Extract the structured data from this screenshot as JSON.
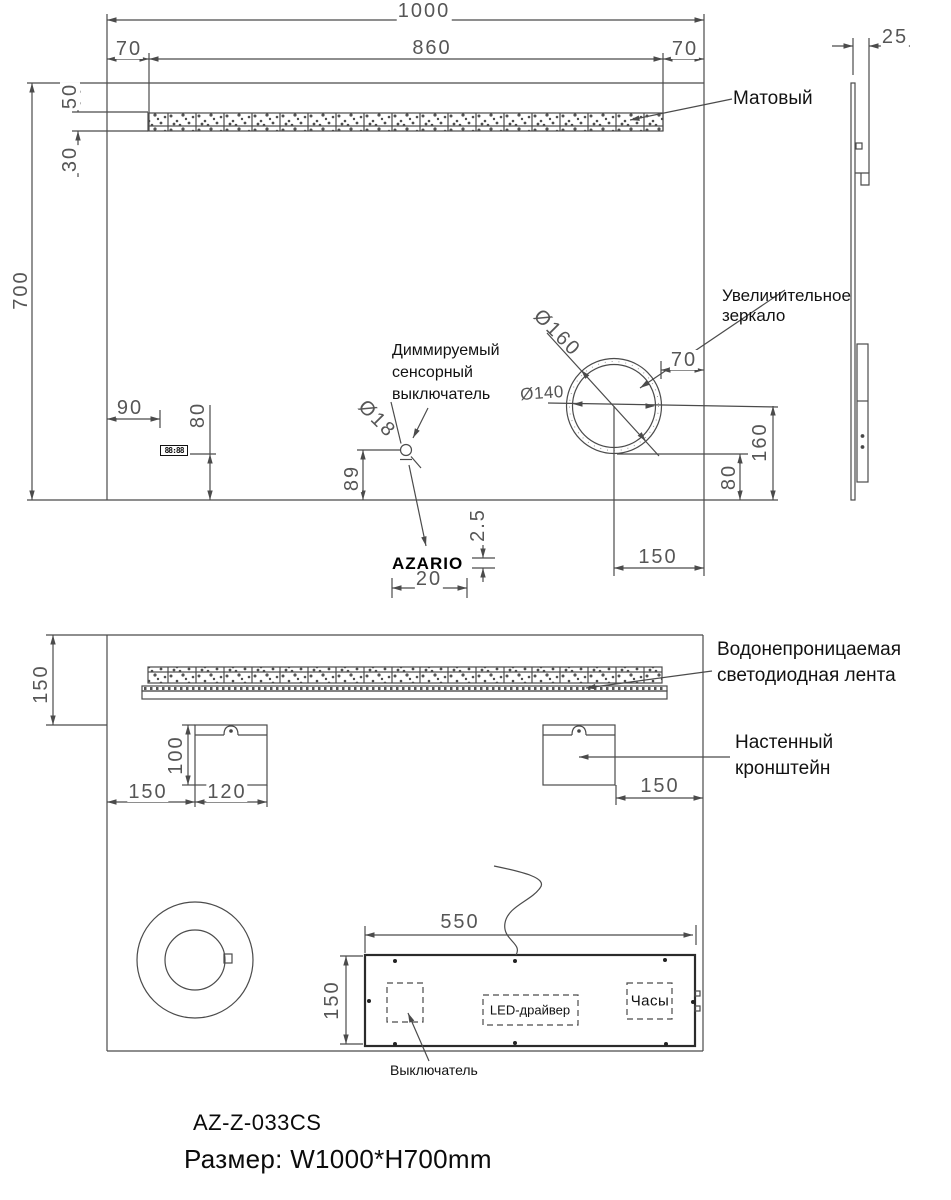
{
  "front_view": {
    "dims": {
      "overall_width": "1000",
      "strip_left_offset": "70",
      "strip_width": "860",
      "strip_right_offset": "70",
      "strip_top_offset": "50",
      "strip_height": "30",
      "overall_height": "700",
      "thickness": "25",
      "clock_left_offset": "90",
      "clock_bottom_offset": "80",
      "sensor_diameter": "Ø18",
      "sensor_bottom_offset": "89",
      "logo_gap": "2.5",
      "logo_width": "20",
      "magnifier_outer_diameter": "Ø160",
      "magnifier_inner_diameter": "Ø140",
      "magnifier_right_offset": "70",
      "magnifier_center_bottom_offset": "160",
      "magnifier_bottom_offset": "80",
      "magnifier_center_right_offset": "150"
    },
    "labels": {
      "matte": "Матовый",
      "magnifier": "Увеличительное\nзеркало",
      "dimmer_switch": "Диммируемый\nсенсорный\nвыключатель"
    },
    "clock_display": "88:88",
    "brand_logo": "AZARIO"
  },
  "rear_view": {
    "dims": {
      "strip_top_offset": "150",
      "bracket_height": "100",
      "bracket_left_offset": "150",
      "bracket_width": "120",
      "bracket_right_offset": "150",
      "junction_box_width": "550",
      "junction_box_height": "150"
    },
    "labels": {
      "led_strip": "Водонепроницаемая\nсветодиодная лента",
      "wall_bracket": "Настенный\nкронштейн",
      "led_driver": "LED-драйвер",
      "clock": "Часы",
      "switch": "Выключатель"
    }
  },
  "footer": {
    "model": "AZ-Z-033CS",
    "size": "Размер: W1000*H700mm"
  }
}
